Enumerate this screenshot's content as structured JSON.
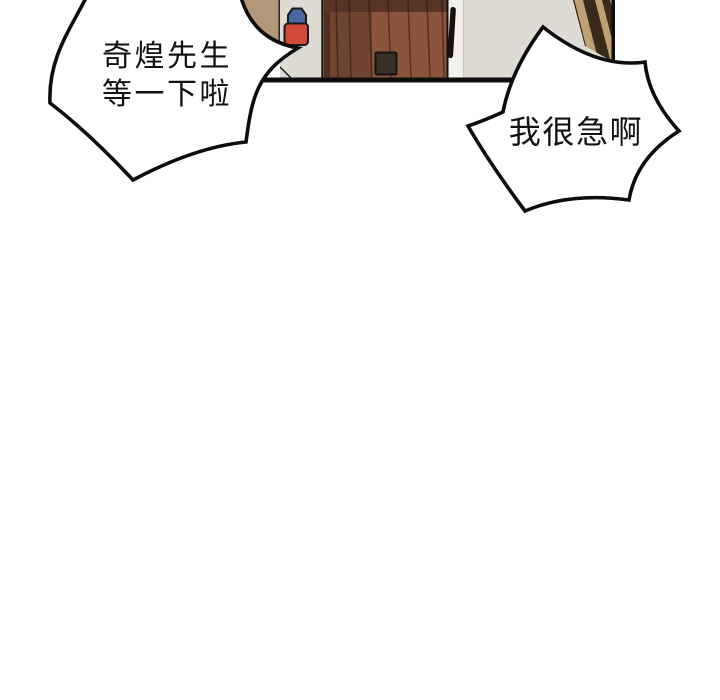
{
  "bubbles": {
    "left": {
      "line1": "奇煌先生",
      "line2": "等一下啦"
    },
    "right": {
      "line1": "我很急啊"
    }
  },
  "panel": {
    "objects": [
      "hallway-wall",
      "fire-extinguisher",
      "wooden-plank-door",
      "door-handle-bar",
      "door-kick-plate",
      "angled-wood-slats"
    ]
  },
  "palette": {
    "outline": "#0d0d0d",
    "bubble_fill": "#ffffff",
    "wall_tan": "#b2977a",
    "wall_gray": "#dedbd5",
    "door_left_dark": "#6f4431",
    "door_right_light": "#8b553b",
    "door_top_band": "#573426",
    "door_edge_shadow": "#4f3020",
    "frame_white": "#f3f1ed",
    "extinguisher_red": "#d34b38",
    "extinguisher_blue": "#4b67a0",
    "slat_tan": "#bfa073",
    "slat_dark": "#3a2a1c",
    "plate_gray": "#3b2f29",
    "handle_black": "#15120f"
  }
}
